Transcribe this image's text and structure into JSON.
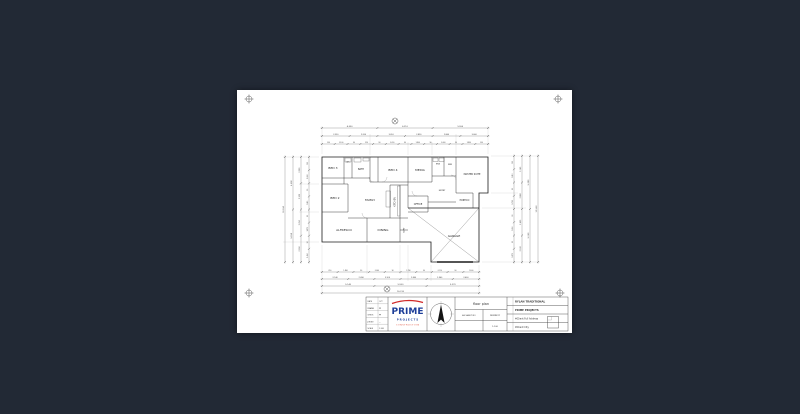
{
  "page": {
    "background": "#222935",
    "sheet_color": "#ffffff"
  },
  "plan": {
    "rooms": {
      "bed3": "BED 3",
      "wc": "WC",
      "bath": "BATH",
      "bed4": "BED 4",
      "media": "MEDIA",
      "ens": "ENS",
      "wir": "WIR",
      "master": "MASTER SUITE",
      "bed2": "BED 2",
      "family": "FAMILY",
      "kitchen": "KITCHEN",
      "office": "OFFICE",
      "entry": "ENTRY",
      "portico": "PORTICO",
      "alfresco": "ALFRESCO",
      "dining": "DINING",
      "garage": "GARAGE",
      "ldry": "LDRY"
    },
    "dims": {
      "t1": [
        "4,550",
        "6,210",
        "5,550"
      ],
      "t2": [
        "2,350",
        "2,200",
        "3,010",
        "2,890",
        "2,860",
        "3,000"
      ],
      "t3": [
        "250",
        "2,100",
        "90",
        "910",
        "90",
        "2,010",
        "90",
        "1,800",
        "90",
        "2,000",
        "90",
        "1,890",
        "250"
      ],
      "b1": [
        "250",
        "1,890",
        "90",
        "2,000",
        "90",
        "1,790",
        "90",
        "2,110",
        "90",
        "1,500"
      ],
      "b2": [
        "2,140",
        "2,090",
        "3,100",
        "2,800",
        "2,960",
        "2,600"
      ],
      "b3": [
        "5,140",
        "5,900",
        "5,270"
      ],
      "b4": [
        "16,310"
      ],
      "l1": [
        "250",
        "1,930",
        "90",
        "2,340",
        "90",
        "1,870",
        "90",
        "1,950"
      ],
      "l2": [
        "3,280",
        "2,920",
        "2,250",
        "2,050"
      ],
      "l3": [
        "5,500",
        "5,050"
      ],
      "l4": [
        "10,550"
      ],
      "r1": [
        "250",
        "2,010",
        "90",
        "1,750",
        "90",
        "2,350",
        "90",
        "1,870"
      ],
      "r2": [
        "3,140",
        "2,860",
        "2,400",
        "2,100"
      ],
      "r3": [
        "5,300",
        "5,250"
      ],
      "r4": [
        "10,550"
      ]
    }
  },
  "title_block": {
    "info_rows": [
      {
        "label": "DATE",
        "value": "OCT"
      },
      {
        "label": "DRAWN",
        "value": "PP"
      },
      {
        "label": "CHECK",
        "value": "PP"
      },
      {
        "label": "JOB NO",
        "value": "—"
      },
      {
        "label": "SCALE",
        "value": "1:100"
      }
    ],
    "logo": {
      "name": "PRIME",
      "sub": "P R O J E C T S",
      "sub2": "C O N S T R U C T I O N"
    },
    "logo_colors": {
      "blue": "#1d3e99",
      "red": "#d02828"
    },
    "sheet_title": "floor plan",
    "row2_left": "A3 SHEET NO",
    "row2_right": "DD/MM/YY",
    "row3_left": "",
    "row3_right": "1:100",
    "project": {
      "line1": "RYLAN TRADITIONAL",
      "line2": "PRIME PROJECTS",
      "line3": "#Client Full Address",
      "line4": "#Client City"
    }
  }
}
